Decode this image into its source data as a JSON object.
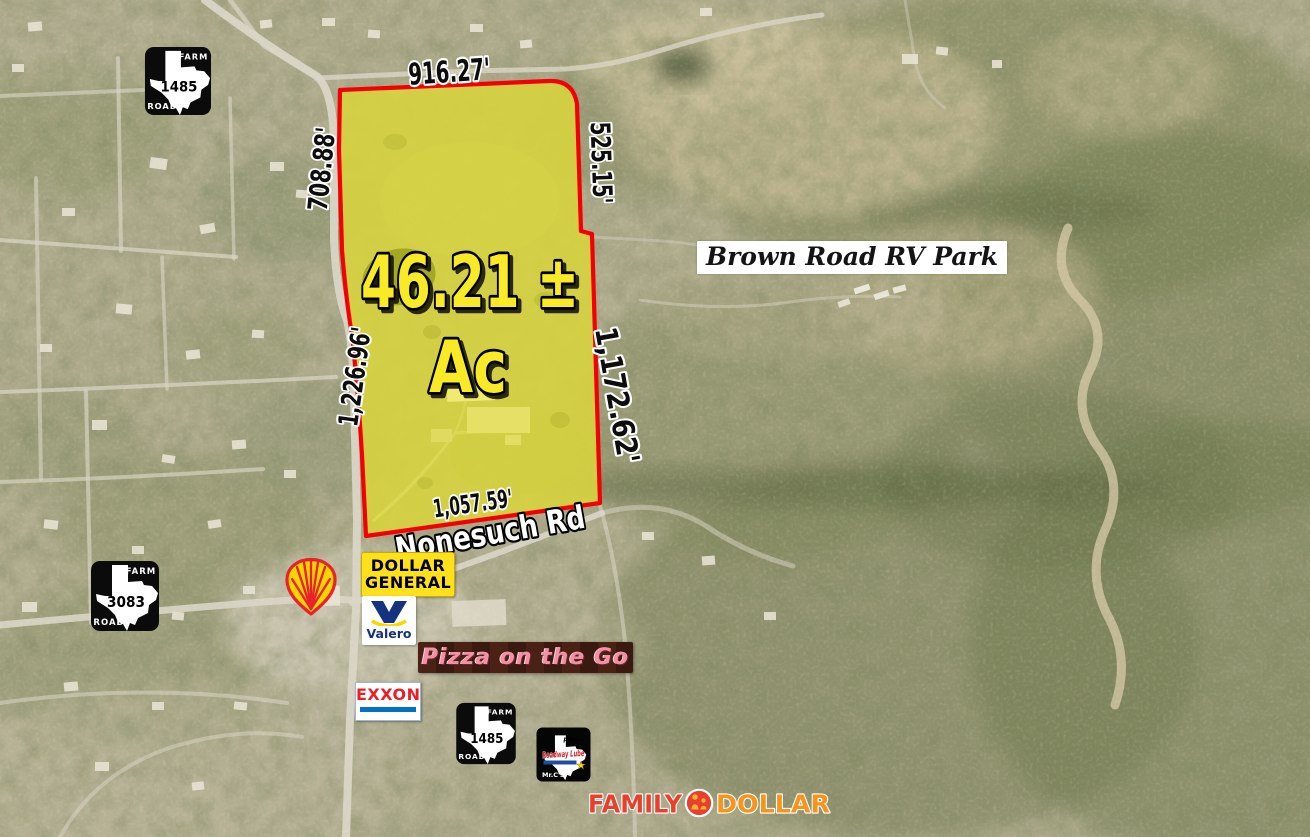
{
  "acreage": {
    "value": "46.21 ±",
    "unit": "Ac"
  },
  "dims": {
    "top": "916.27'",
    "nw": "708.88'",
    "ne": "525.15'",
    "w": "1,226.96'",
    "e": "1,172.62'",
    "s": "1,057.59'"
  },
  "roads": {
    "nonesuch": "Nonesuch Rd"
  },
  "labels": {
    "rv_park": "Brown Road RV Park"
  },
  "shields": [
    {
      "top": "FARM",
      "side": "ROAD",
      "num": "1485"
    },
    {
      "top": "FARM",
      "side": "ROAD",
      "num": "3083"
    },
    {
      "top": "FARM",
      "side": "ROAD",
      "num": "1485"
    }
  ],
  "brands": {
    "dollar_general": {
      "l1": "DOLLAR",
      "l2": "GENERAL"
    },
    "valero": "Valero",
    "pizza": "Pizza on the Go",
    "exxon": "EXXON",
    "roadway": {
      "plus": "plus...",
      "name": "Roadway Lube",
      "owner": "Mr.C's"
    },
    "family_dollar": {
      "w1": "FAMILY",
      "w2": "DOLLAR"
    }
  },
  "icons": {
    "roadway_star": "★"
  },
  "colors": {
    "boundary_red": "#f50000",
    "property_yellow": "#d6d75c",
    "acreage_text": "#f8ea25",
    "dg_yellow": "#ffe11b",
    "shell_red": "#e8222d",
    "shell_yellow": "#ffd500",
    "valero_blue": "#14337f",
    "exxon_red": "#ee1d25",
    "exxon_blue": "#0072c6",
    "family_red": "#e8402c",
    "family_orange": "#f7941d"
  }
}
